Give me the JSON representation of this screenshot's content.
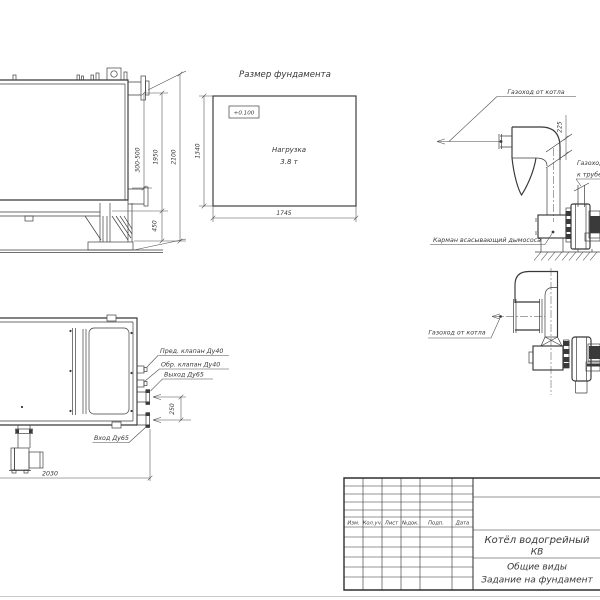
{
  "page": {
    "bg": "#ffffff",
    "ink": "#3f3f3f"
  },
  "foundation_view": {
    "title": "Размер фундамента",
    "level_mark": "+0.100",
    "load_line1": "Нагрузка",
    "load_line2": "3.8 т",
    "dim_height": "1340",
    "dim_width": "1745"
  },
  "boiler_side_view": {
    "dim_stub_range": "300-500",
    "dim_upper": "1950",
    "dim_total": "2100",
    "dim_base": "450"
  },
  "gas_duct_elevation": {
    "label_from_boiler": "Газоход от котла",
    "label_to_chimney_line1": "Газоход",
    "label_to_chimney_line2": "к трубе",
    "dim_bend": "225",
    "label_pocket": "Карман всасывающий дымососа"
  },
  "gas_duct_plan": {
    "label_from_boiler": "Газоход от котла"
  },
  "boiler_plan_view": {
    "label_safety_valve": "Пред. клапан Ду40",
    "label_check_valve": "Обр. клапан Ду40",
    "label_outlet": "Выход Ду65",
    "label_inlet": "Вход Ду65",
    "dim_nozzles": "250",
    "dim_length": "2030"
  },
  "title_block": {
    "columns": [
      "Изм.",
      "Кол.уч.",
      "Лист",
      "№док.",
      "Подп.",
      "Дата"
    ],
    "doc_name_line1": "Котёл водогрейный",
    "doc_name_line2": "КВ",
    "sheet_name_line1": "Общие виды",
    "sheet_name_line2": "Задание на фундамент"
  }
}
